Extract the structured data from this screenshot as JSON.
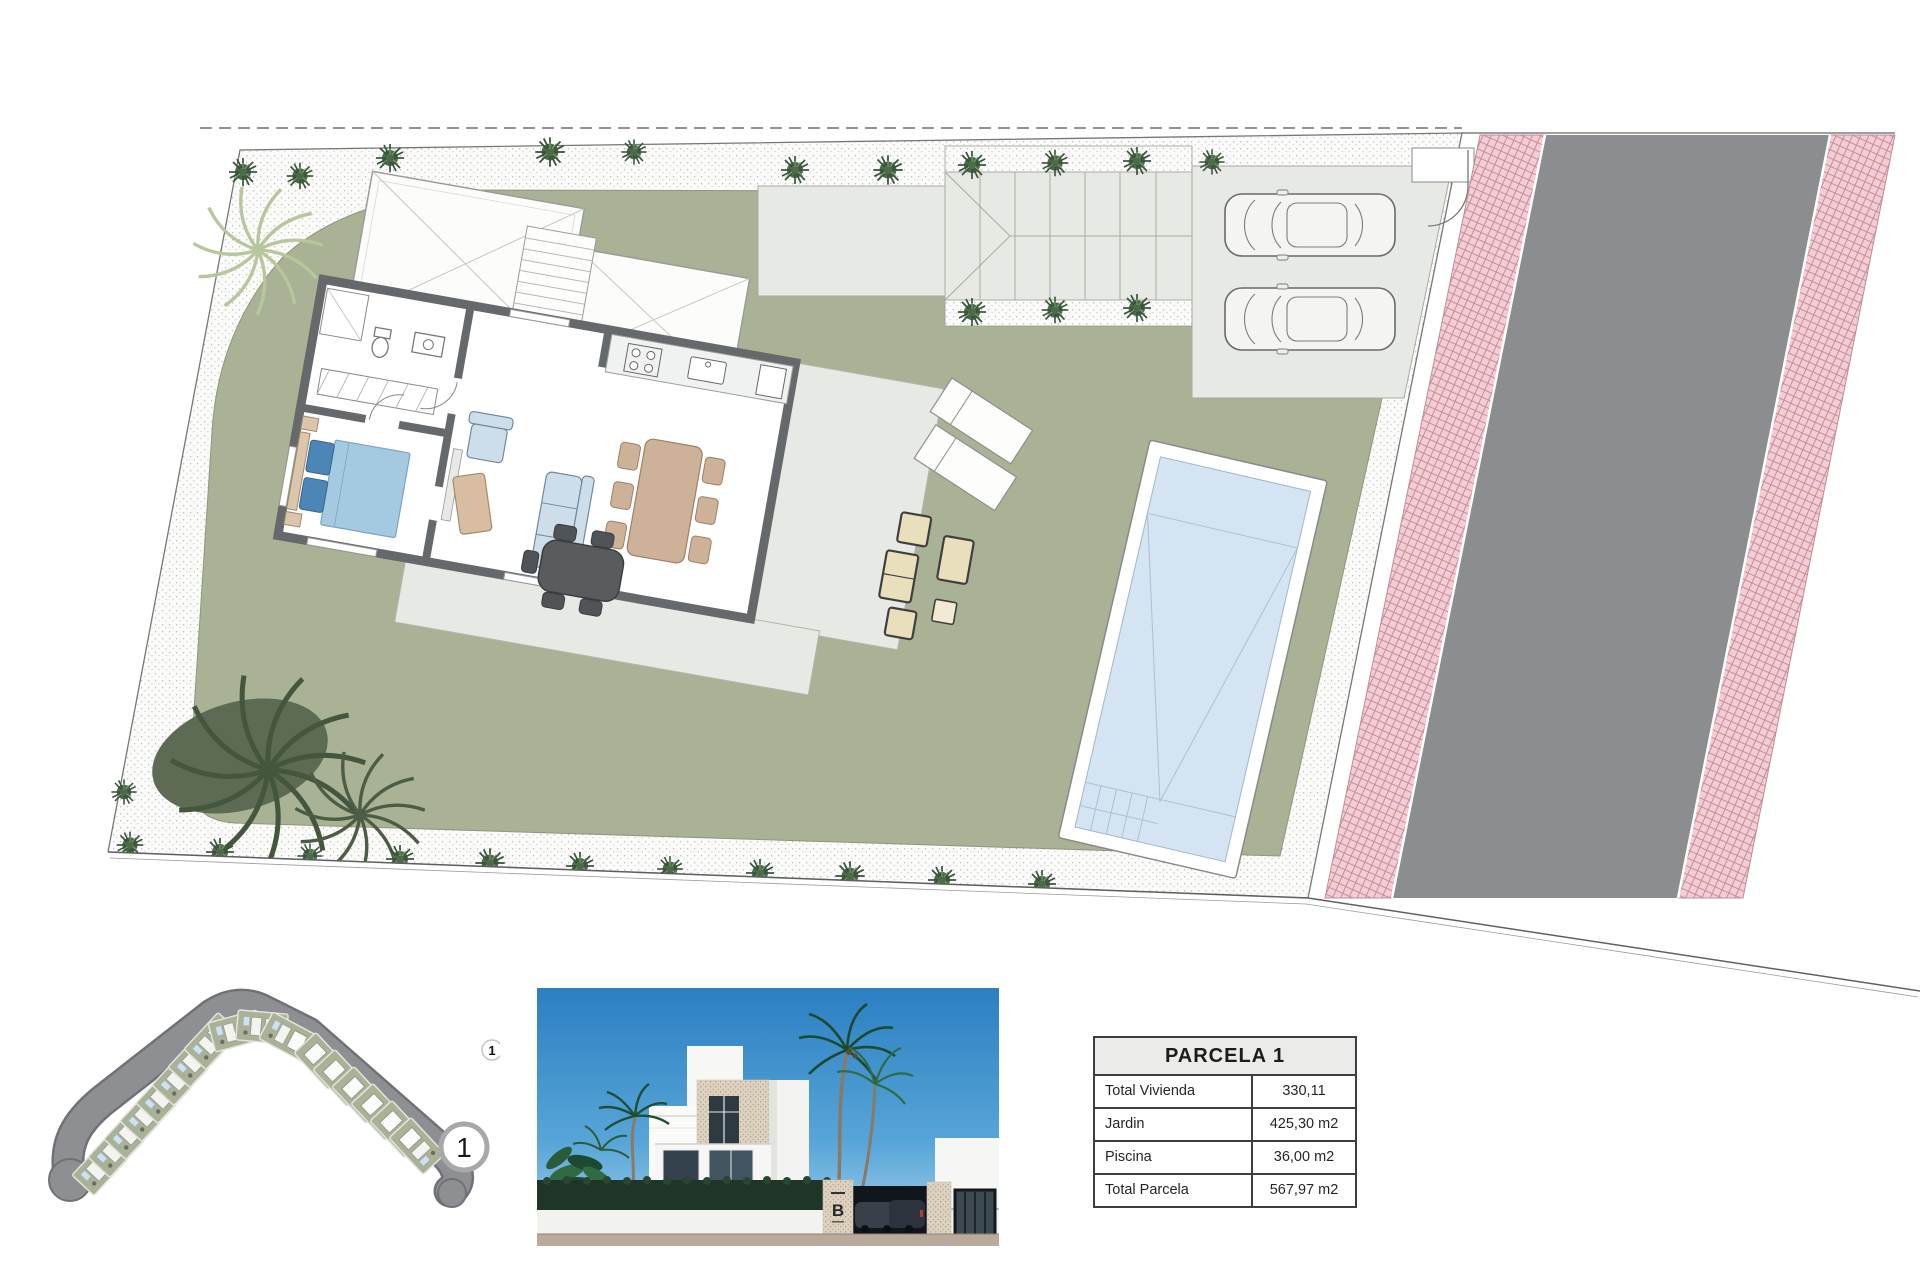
{
  "parcel_table": {
    "title": "PARCELA 1",
    "rows": [
      {
        "label": "Total Vivienda",
        "value": "330,11"
      },
      {
        "label": "Jardin",
        "value": "425,30 m2"
      },
      {
        "label": "Piscina",
        "value": "36,00 m2"
      },
      {
        "label": "Total Parcela",
        "value": "567,97 m2"
      }
    ]
  },
  "location_map": {
    "plot_badge": "1",
    "mini_marker": "1"
  },
  "render": {
    "logo_letter": "B"
  },
  "colors": {
    "garden_green": "#a9b294",
    "terrace_gray": "#e7e9e5",
    "road_gray": "#8b8d91",
    "sidewalk_pink": "#f5ccd4",
    "pool_blue": "#d4e4f3",
    "wall_gray": "#66696c"
  }
}
